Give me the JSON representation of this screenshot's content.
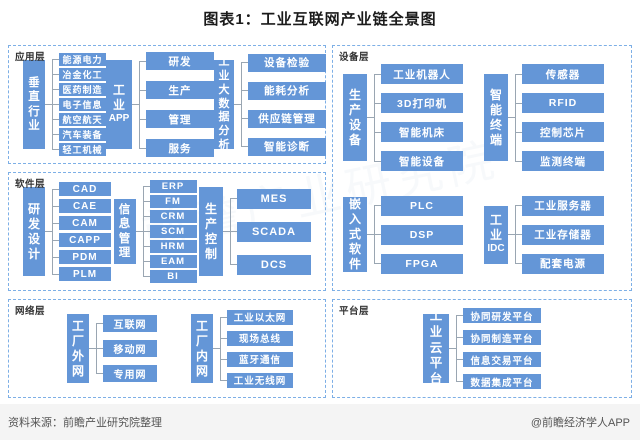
{
  "title": "图表1：工业互联网产业链全景图",
  "watermark": "前瞻产业研究院",
  "colors": {
    "box_blue": "#6496D7",
    "dash_border": "#7DAFE6",
    "connector": "#9AA6B2"
  },
  "footer": {
    "source": "资料来源：前瞻产业研究院整理",
    "credit": "@前瞻经济学人APP"
  },
  "sections": [
    {
      "label": "应用层",
      "groups": [
        {
          "parent": "垂直行业",
          "children": [
            "能源电力",
            "冶金化工",
            "医药制造",
            "电子信息",
            "航空航天",
            "汽车装备",
            "轻工机械"
          ]
        },
        {
          "parent": "工业APP",
          "children": [
            "研发",
            "生产",
            "管理",
            "服务"
          ]
        },
        {
          "parent": "工业大数据分析",
          "children": [
            "设备检验",
            "能耗分析",
            "供应链管理",
            "智能诊断"
          ]
        }
      ]
    },
    {
      "label": "设备层",
      "groups": [
        {
          "parent": "生产设备",
          "children": [
            "工业机器人",
            "3D打印机",
            "智能机床",
            "智能设备"
          ]
        },
        {
          "parent": "智能终端",
          "children": [
            "传感器",
            "RFID",
            "控制芯片",
            "监测终端"
          ]
        },
        {
          "parent": "嵌入式软件",
          "children": [
            "PLC",
            "DSP",
            "FPGA"
          ]
        },
        {
          "parent": "工业IDC",
          "children": [
            "工业服务器",
            "工业存储器",
            "配套电源"
          ]
        }
      ]
    },
    {
      "label": "软件层",
      "groups": [
        {
          "parent": "研发设计",
          "children": [
            "CAD",
            "CAE",
            "CAM",
            "CAPP",
            "PDM",
            "PLM"
          ]
        },
        {
          "parent": "信息管理",
          "children": [
            "ERP",
            "FM",
            "CRM",
            "SCM",
            "HRM",
            "EAM",
            "BI"
          ]
        },
        {
          "parent": "生产控制",
          "children": [
            "MES",
            "SCADA",
            "DCS"
          ]
        }
      ]
    },
    {
      "label": "网络层",
      "groups": [
        {
          "parent": "工厂外网",
          "children": [
            "互联网",
            "移动网",
            "专用网"
          ]
        },
        {
          "parent": "工厂内网",
          "children": [
            "工业以太网",
            "现场总线",
            "蓝牙通信",
            "工业无线网"
          ]
        }
      ]
    },
    {
      "label": "平台层",
      "groups": [
        {
          "parent": "工业云平台",
          "children": [
            "协同研发平台",
            "协同制造平台",
            "信息交易平台",
            "数据集成平台"
          ]
        }
      ]
    }
  ]
}
